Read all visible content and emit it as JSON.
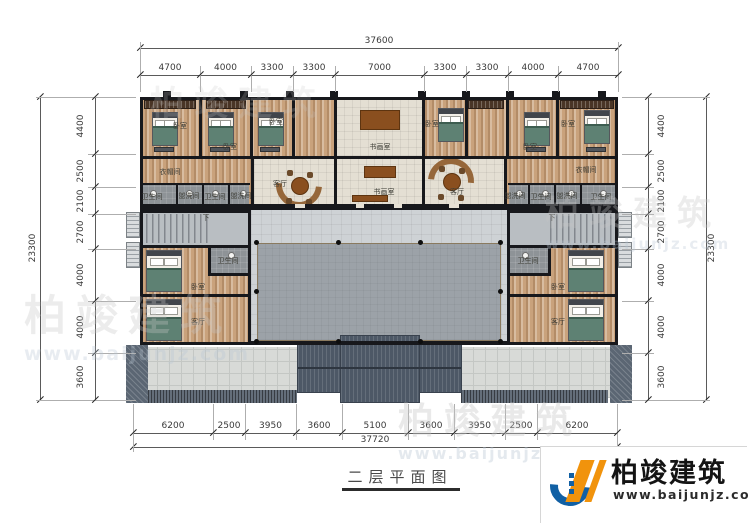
{
  "drawing": {
    "title": "二层平面图",
    "dimensions": {
      "top": {
        "total": "37600",
        "segments": [
          "4700",
          "4000",
          "3300",
          "3300",
          "7000",
          "3300",
          "3300",
          "4000",
          "4700"
        ]
      },
      "bottom": {
        "total": "37720",
        "segments": [
          "6200",
          "2500",
          "3950",
          "3600",
          "5100",
          "3600",
          "3950",
          "2500",
          "6200"
        ]
      },
      "left": {
        "total": "23300",
        "segments": [
          "4400",
          "2500",
          "2100",
          "2700",
          "4000",
          "4000",
          "3600"
        ]
      },
      "right": {
        "total": "23300",
        "segments": [
          "4400",
          "2500",
          "2100",
          "2700",
          "4000",
          "4000",
          "3600"
        ]
      }
    },
    "room_labels": [
      {
        "text": "卧室",
        "x": 180,
        "y": 126
      },
      {
        "text": "卧室",
        "x": 230,
        "y": 147
      },
      {
        "text": "卧室",
        "x": 276,
        "y": 122
      },
      {
        "text": "书画室",
        "x": 380,
        "y": 147
      },
      {
        "text": "卧室",
        "x": 432,
        "y": 124
      },
      {
        "text": "卧室",
        "x": 530,
        "y": 147
      },
      {
        "text": "卧室",
        "x": 568,
        "y": 124
      },
      {
        "text": "衣帽间",
        "x": 170,
        "y": 172
      },
      {
        "text": "衣帽间",
        "x": 586,
        "y": 170
      },
      {
        "text": "卫生间",
        "x": 152,
        "y": 197
      },
      {
        "text": "盥洗间",
        "x": 189,
        "y": 196
      },
      {
        "text": "卫生间",
        "x": 215,
        "y": 197
      },
      {
        "text": "盥洗间",
        "x": 241,
        "y": 196
      },
      {
        "text": "盥洗间",
        "x": 515,
        "y": 196
      },
      {
        "text": "卫生间",
        "x": 541,
        "y": 197
      },
      {
        "text": "盥洗间",
        "x": 567,
        "y": 196
      },
      {
        "text": "卫生间",
        "x": 601,
        "y": 197
      },
      {
        "text": "客厅",
        "x": 280,
        "y": 184
      },
      {
        "text": "书画室",
        "x": 384,
        "y": 192
      },
      {
        "text": "客厅",
        "x": 457,
        "y": 192
      },
      {
        "text": "下",
        "x": 206,
        "y": 218
      },
      {
        "text": "下",
        "x": 552,
        "y": 218
      },
      {
        "text": "卫生间",
        "x": 228,
        "y": 261
      },
      {
        "text": "卧室",
        "x": 198,
        "y": 287
      },
      {
        "text": "客厅",
        "x": 198,
        "y": 322
      },
      {
        "text": "卫生间",
        "x": 528,
        "y": 261
      },
      {
        "text": "卧室",
        "x": 558,
        "y": 287
      },
      {
        "text": "客厅",
        "x": 558,
        "y": 322
      }
    ]
  },
  "watermarks": [
    {
      "text": "柏竣建筑",
      "url": "",
      "x": 150,
      "y": 76,
      "size": 34,
      "opacity": 0.22
    },
    {
      "text": "柏竣建筑",
      "url": "www.baijunjz.com",
      "x": 24,
      "y": 282,
      "size": 42,
      "opacity": 0.32
    },
    {
      "text": "柏竣建筑",
      "url": "www.baijunjz.com",
      "x": 545,
      "y": 186,
      "size": 34,
      "opacity": 0.32
    },
    {
      "text": "柏竣建筑",
      "url": "www.baijunjz.com",
      "x": 398,
      "y": 392,
      "size": 36,
      "opacity": 0.38
    }
  ],
  "logo": {
    "name": "柏竣建筑",
    "url": "www.baijunjz.com"
  },
  "colors": {
    "brand_orange": "#f1930c",
    "brand_blue": "#1160a4"
  }
}
